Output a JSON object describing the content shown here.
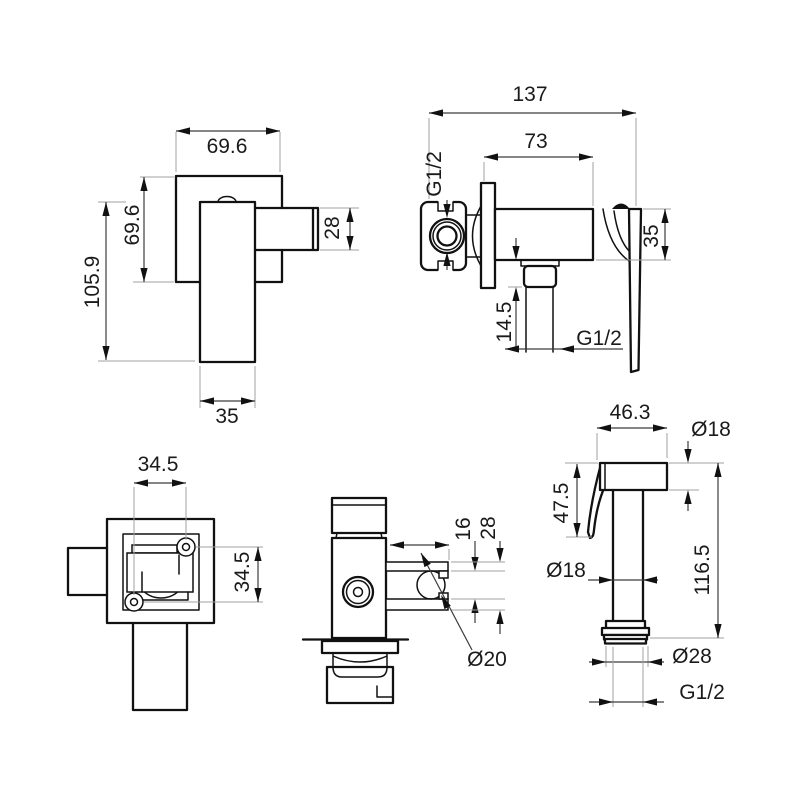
{
  "title": "bidet-mixer-technical-drawing",
  "colors": {
    "line": "#111111",
    "dimension": "#3c3c3c",
    "extension": "#a0a0a0",
    "text": "#1a1a1a",
    "background": "#ffffff"
  },
  "views": {
    "front": {
      "label": "front-view-mixer",
      "dim_width": "69.6",
      "dim_height": "69.6",
      "dim_total_height": "105.9",
      "dim_spout_height": "28",
      "dim_base_width": "35"
    },
    "side": {
      "label": "side-view-mixer",
      "dim_depth": "137",
      "dim_body_depth": "73",
      "dim_inlet_thread": "G1/2",
      "dim_handle_drop": "35",
      "dim_outlet_offset": "14.5",
      "dim_outlet_thread": "G1/2"
    },
    "top": {
      "label": "top-view-mixer",
      "dim_spacing_h": "34.5",
      "dim_spacing_v": "34.5"
    },
    "holder": {
      "label": "side-view-valve-with-holder",
      "dim_slot": "16",
      "dim_height": "28",
      "dim_hole": "Ø20"
    },
    "shower": {
      "label": "hand-shower-view",
      "dim_head_width": "46.3",
      "dim_head_dia": "Ø18",
      "dim_head_height": "47.5",
      "dim_tube_dia": "Ø18",
      "dim_length": "116.5",
      "dim_nut_dia": "Ø28",
      "dim_thread": "G1/2"
    }
  }
}
